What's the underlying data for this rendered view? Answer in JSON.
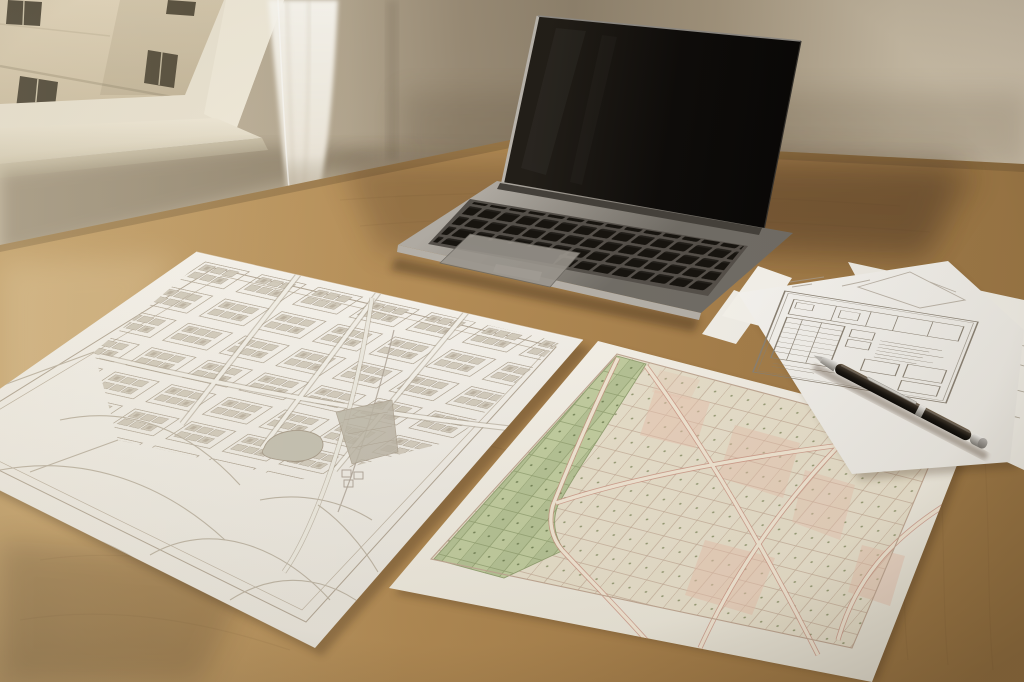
{
  "scene": {
    "type": "photograph",
    "description": "Photograph of a light wooden desk beside a window: an open silver laptop with a dark powered-off screen sits behind three printouts - a pencil-sketched city street map, a colored cadastral zoning map with green and pink parcels, and pencil technical plan sheets - with a dark pen with silver trim resting on the sheets.",
    "objects": {
      "window": {
        "label": "window with view of beige building facade",
        "state": "daylight"
      },
      "curtain": {
        "label": "sheer white curtain"
      },
      "wall": {
        "label": "beige interior wall"
      },
      "desk": {
        "label": "light oak wooden desktop"
      },
      "laptop": {
        "label": "silver aluminum laptop",
        "state": "open, screen off",
        "keyboard": "black keys",
        "trackpad": "visible"
      },
      "sketch_map": {
        "label": "pencil line drawing of a city plan",
        "features": [
          "street grid with building blocks",
          "roundabout",
          "shaded pond",
          "diagonal highway",
          "field roads"
        ]
      },
      "zoning_map": {
        "label": "colored cadastral parcel map",
        "features": [
          "green field parcels",
          "pink road network",
          "beige parcels with lot dots"
        ]
      },
      "diagram_sheets": {
        "label": "stack of pencil technical plan sheets",
        "count": 3
      },
      "pen": {
        "label": "dark brown pen with silver nib, band and cap"
      }
    },
    "palette": {
      "wall": "#a2947d",
      "wall_light": "#d0c4ae",
      "desk_wood": "#b08a54",
      "desk_shadow": "#7e5f3c",
      "paper": "#f3f0e9",
      "pencil_line": "#a79d8c",
      "laptop_silver": "#a29d95",
      "screen_black": "#12100d",
      "map_green": "#b5c295",
      "map_pink_road": "#cf9484",
      "map_beige": "#e8e1cd",
      "parcel_dot": "#8a8f68",
      "pen_dark": "#241e17",
      "pen_silver": "#c9c6c0",
      "building_facade": "#d9cbb0",
      "curtain": "#f8f5ee"
    }
  }
}
